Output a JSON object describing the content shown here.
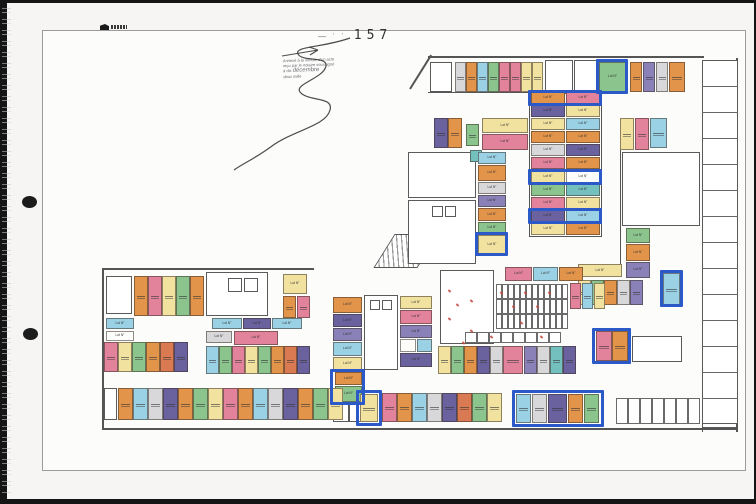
{
  "page": {
    "number": "157",
    "pre_marks": "— ˈ ˈ",
    "stamp_logo": "architect-logo"
  },
  "annotation": {
    "line1": "Annexé à la minute d'un acte",
    "line2": "reçu par le notaire soussigné",
    "line3": "à dix",
    "word_cursive": "décembre",
    "line4": "deux mille"
  },
  "plan": {
    "unit_label": "Lot N°",
    "colors": {
      "o": "#E2944A",
      "r": "#D97A52",
      "p": "#E2839B",
      "y": "#F1E2A0",
      "g": "#8BC48C",
      "pu": "#8A81B8",
      "dpu": "#6A619F",
      "b": "#9AD1E5",
      "t": "#74C0BF",
      "gr": "#D8D8DB",
      "w": "#FDFDFB"
    },
    "highlight_color": "#2B59C8",
    "units": [
      [
        455,
        62,
        11,
        30,
        "gr"
      ],
      [
        466,
        62,
        11,
        30,
        "o"
      ],
      [
        477,
        62,
        11,
        30,
        "b"
      ],
      [
        488,
        62,
        11,
        30,
        "g"
      ],
      [
        499,
        62,
        11,
        30,
        "p"
      ],
      [
        510,
        62,
        11,
        30,
        "p"
      ],
      [
        521,
        62,
        11,
        30,
        "y"
      ],
      [
        532,
        62,
        11,
        30,
        "y"
      ],
      [
        599,
        62,
        27,
        30,
        "g"
      ],
      [
        630,
        62,
        12,
        30,
        "o"
      ],
      [
        643,
        62,
        12,
        30,
        "pu"
      ],
      [
        656,
        62,
        12,
        30,
        "gr"
      ],
      [
        669,
        62,
        16,
        30,
        "o"
      ],
      [
        620,
        118,
        14,
        32,
        "y"
      ],
      [
        635,
        118,
        14,
        32,
        "p"
      ],
      [
        650,
        118,
        17,
        30,
        "b"
      ],
      [
        626,
        228,
        24,
        15,
        "g"
      ],
      [
        626,
        244,
        24,
        17,
        "o"
      ],
      [
        626,
        262,
        24,
        16,
        "pu"
      ],
      [
        578,
        264,
        44,
        13,
        "y"
      ],
      [
        578,
        280,
        13,
        25,
        "y"
      ],
      [
        591,
        280,
        13,
        25,
        "g"
      ],
      [
        604,
        280,
        13,
        25,
        "o"
      ],
      [
        617,
        280,
        13,
        25,
        "gr"
      ],
      [
        630,
        280,
        13,
        25,
        "pu"
      ],
      [
        663,
        273,
        17,
        32,
        "b"
      ],
      [
        596,
        331,
        16,
        30,
        "p"
      ],
      [
        612,
        331,
        16,
        30,
        "o"
      ],
      [
        531,
        92,
        34,
        12,
        "o"
      ],
      [
        566,
        92,
        34,
        12,
        "p"
      ],
      [
        531,
        105,
        34,
        12,
        "dpu"
      ],
      [
        566,
        105,
        34,
        12,
        "y"
      ],
      [
        531,
        118,
        34,
        12,
        "y"
      ],
      [
        566,
        118,
        34,
        12,
        "b"
      ],
      [
        531,
        131,
        34,
        12,
        "o"
      ],
      [
        566,
        131,
        34,
        12,
        "o"
      ],
      [
        531,
        144,
        34,
        12,
        "gr"
      ],
      [
        566,
        144,
        34,
        12,
        "dpu"
      ],
      [
        531,
        157,
        34,
        12,
        "p"
      ],
      [
        566,
        157,
        34,
        12,
        "o"
      ],
      [
        531,
        171,
        34,
        12,
        "y"
      ],
      [
        566,
        171,
        34,
        12,
        "w"
      ],
      [
        531,
        184,
        34,
        12,
        "g"
      ],
      [
        566,
        184,
        34,
        12,
        "t"
      ],
      [
        531,
        197,
        34,
        12,
        "p"
      ],
      [
        566,
        197,
        34,
        12,
        "y"
      ],
      [
        531,
        210,
        34,
        12,
        "dpu"
      ],
      [
        566,
        210,
        34,
        12,
        "b"
      ],
      [
        531,
        223,
        34,
        12,
        "y"
      ],
      [
        566,
        223,
        34,
        12,
        "o"
      ],
      [
        434,
        118,
        14,
        30,
        "dpu"
      ],
      [
        448,
        118,
        14,
        30,
        "o"
      ],
      [
        466,
        124,
        13,
        22,
        "g"
      ],
      [
        482,
        118,
        46,
        15,
        "y"
      ],
      [
        482,
        134,
        46,
        16,
        "p"
      ],
      [
        470,
        150,
        12,
        12,
        "t"
      ],
      [
        478,
        152,
        28,
        12,
        "b"
      ],
      [
        478,
        165,
        28,
        16,
        "o"
      ],
      [
        478,
        182,
        28,
        12,
        "gr"
      ],
      [
        478,
        195,
        28,
        12,
        "pu"
      ],
      [
        478,
        208,
        28,
        13,
        "o"
      ],
      [
        478,
        222,
        28,
        12,
        "g"
      ],
      [
        478,
        235,
        28,
        19,
        "y"
      ],
      [
        134,
        276,
        14,
        40,
        "o"
      ],
      [
        148,
        276,
        14,
        40,
        "p"
      ],
      [
        162,
        276,
        14,
        40,
        "y"
      ],
      [
        176,
        276,
        14,
        40,
        "g"
      ],
      [
        190,
        276,
        14,
        40,
        "o"
      ],
      [
        106,
        318,
        28,
        11,
        "b"
      ],
      [
        106,
        331,
        28,
        10,
        "w"
      ],
      [
        104,
        342,
        14,
        30,
        "p"
      ],
      [
        118,
        342,
        14,
        30,
        "y"
      ],
      [
        132,
        342,
        14,
        30,
        "g"
      ],
      [
        146,
        342,
        14,
        30,
        "o"
      ],
      [
        160,
        342,
        14,
        30,
        "r"
      ],
      [
        174,
        342,
        14,
        30,
        "dpu"
      ],
      [
        283,
        274,
        24,
        20,
        "y"
      ],
      [
        283,
        296,
        13,
        22,
        "o"
      ],
      [
        297,
        296,
        13,
        22,
        "p"
      ],
      [
        212,
        318,
        30,
        11,
        "b"
      ],
      [
        243,
        318,
        28,
        11,
        "dpu"
      ],
      [
        272,
        318,
        30,
        11,
        "b"
      ],
      [
        206,
        331,
        26,
        12,
        "gr"
      ],
      [
        234,
        331,
        44,
        14,
        "p"
      ],
      [
        206,
        346,
        13,
        28,
        "b"
      ],
      [
        219,
        346,
        13,
        28,
        "g"
      ],
      [
        232,
        346,
        13,
        28,
        "p"
      ],
      [
        245,
        346,
        13,
        28,
        "y"
      ],
      [
        258,
        346,
        13,
        28,
        "g"
      ],
      [
        271,
        346,
        13,
        28,
        "o"
      ],
      [
        284,
        346,
        13,
        28,
        "r"
      ],
      [
        297,
        346,
        13,
        28,
        "dpu"
      ],
      [
        333,
        297,
        29,
        16,
        "o"
      ],
      [
        333,
        314,
        29,
        13,
        "dpu"
      ],
      [
        333,
        328,
        29,
        13,
        "pu"
      ],
      [
        333,
        342,
        29,
        14,
        "b"
      ],
      [
        333,
        357,
        29,
        13,
        "y"
      ],
      [
        335,
        372,
        27,
        13,
        "o"
      ],
      [
        335,
        386,
        27,
        16,
        "g"
      ],
      [
        400,
        296,
        32,
        13,
        "y"
      ],
      [
        400,
        310,
        32,
        14,
        "p"
      ],
      [
        400,
        325,
        32,
        13,
        "pu"
      ],
      [
        400,
        339,
        16,
        13,
        "w"
      ],
      [
        417,
        339,
        15,
        13,
        "b"
      ],
      [
        400,
        353,
        32,
        14,
        "dpu"
      ],
      [
        505,
        267,
        27,
        14,
        "p"
      ],
      [
        533,
        267,
        25,
        14,
        "b"
      ],
      [
        559,
        267,
        24,
        14,
        "o"
      ],
      [
        570,
        283,
        11,
        26,
        "p"
      ],
      [
        582,
        283,
        11,
        26,
        "b"
      ],
      [
        594,
        283,
        11,
        26,
        "y"
      ],
      [
        438,
        346,
        13,
        28,
        "y"
      ],
      [
        451,
        346,
        13,
        28,
        "g"
      ],
      [
        464,
        346,
        13,
        28,
        "o"
      ],
      [
        477,
        346,
        13,
        28,
        "dpu"
      ],
      [
        490,
        346,
        13,
        28,
        "gr"
      ],
      [
        503,
        346,
        20,
        28,
        "p"
      ],
      [
        524,
        346,
        13,
        28,
        "pu"
      ],
      [
        537,
        346,
        13,
        28,
        "gr"
      ],
      [
        550,
        346,
        13,
        28,
        "t"
      ],
      [
        563,
        346,
        13,
        28,
        "dpu"
      ],
      [
        118,
        388,
        15,
        32,
        "o"
      ],
      [
        133,
        388,
        15,
        32,
        "b"
      ],
      [
        148,
        388,
        15,
        32,
        "gr"
      ],
      [
        163,
        388,
        15,
        32,
        "dpu"
      ],
      [
        178,
        388,
        15,
        32,
        "o"
      ],
      [
        193,
        388,
        15,
        32,
        "g"
      ],
      [
        208,
        388,
        15,
        32,
        "y"
      ],
      [
        223,
        388,
        15,
        32,
        "p"
      ],
      [
        238,
        388,
        15,
        32,
        "o"
      ],
      [
        253,
        388,
        15,
        32,
        "b"
      ],
      [
        268,
        388,
        15,
        32,
        "gr"
      ],
      [
        283,
        388,
        15,
        32,
        "dpu"
      ],
      [
        298,
        388,
        15,
        32,
        "o"
      ],
      [
        313,
        388,
        15,
        32,
        "g"
      ],
      [
        328,
        388,
        15,
        32,
        "y"
      ],
      [
        360,
        394,
        18,
        28,
        "y"
      ],
      [
        382,
        393,
        15,
        29,
        "p"
      ],
      [
        397,
        393,
        15,
        29,
        "o"
      ],
      [
        412,
        393,
        15,
        29,
        "b"
      ],
      [
        427,
        393,
        15,
        29,
        "gr"
      ],
      [
        442,
        393,
        15,
        29,
        "dpu"
      ],
      [
        457,
        393,
        15,
        29,
        "r"
      ],
      [
        472,
        393,
        15,
        29,
        "g"
      ],
      [
        487,
        393,
        15,
        29,
        "y"
      ],
      [
        516,
        394,
        15,
        29,
        "b"
      ],
      [
        532,
        394,
        15,
        29,
        "gr"
      ],
      [
        548,
        394,
        19,
        29,
        "dpu"
      ],
      [
        568,
        394,
        15,
        29,
        "o"
      ],
      [
        584,
        394,
        15,
        29,
        "g"
      ]
    ],
    "white_rooms": [
      [
        430,
        62,
        22,
        30
      ],
      [
        545,
        60,
        28,
        34
      ],
      [
        574,
        60,
        26,
        34
      ],
      [
        408,
        152,
        68,
        46
      ],
      [
        408,
        200,
        68,
        64
      ],
      [
        622,
        152,
        78,
        74
      ],
      [
        106,
        276,
        26,
        38
      ],
      [
        206,
        272,
        62,
        44
      ],
      [
        364,
        295,
        34,
        75
      ],
      [
        333,
        400,
        16,
        22
      ],
      [
        349,
        400,
        16,
        22
      ],
      [
        440,
        270,
        54,
        74
      ],
      [
        632,
        336,
        50,
        26
      ],
      [
        702,
        392,
        36,
        36
      ],
      [
        104,
        388,
        13,
        32
      ]
    ],
    "small_rooms": [
      [
        432,
        206,
        11,
        11
      ],
      [
        445,
        206,
        11,
        11
      ],
      [
        370,
        300,
        10,
        10
      ],
      [
        382,
        300,
        10,
        10
      ],
      [
        228,
        278,
        14,
        14
      ],
      [
        244,
        278,
        14,
        14
      ]
    ],
    "walls": [
      [
        428,
        56,
        276,
        2
      ],
      [
        736,
        58,
        2,
        374
      ],
      [
        702,
        60,
        1,
        372
      ],
      [
        102,
        428,
        636,
        2
      ],
      [
        102,
        268,
        2,
        162
      ],
      [
        102,
        268,
        212,
        2
      ],
      [
        529,
        90,
        73,
        1
      ],
      [
        529,
        236,
        73,
        1
      ],
      [
        529,
        90,
        1,
        147
      ],
      [
        601,
        90,
        1,
        147
      ],
      [
        428,
        92,
        100,
        1
      ],
      [
        620,
        150,
        1,
        116
      ]
    ],
    "diagonal_wall": {
      "x": 410,
      "y": 88,
      "len": 40,
      "angle": -58
    },
    "highlights": [
      [
        596,
        59,
        32,
        35
      ],
      [
        528,
        90,
        74,
        16
      ],
      [
        528,
        169,
        74,
        16
      ],
      [
        528,
        208,
        74,
        16
      ],
      [
        475,
        232,
        33,
        24
      ],
      [
        660,
        270,
        23,
        37
      ],
      [
        592,
        328,
        39,
        36
      ],
      [
        330,
        369,
        35,
        36
      ],
      [
        356,
        390,
        26,
        36
      ],
      [
        512,
        390,
        92,
        37
      ]
    ],
    "caves_grid": {
      "x": 496,
      "y": 284,
      "rows": 3,
      "cols": 12,
      "cw": 6,
      "ch": 15
    },
    "caves_row": {
      "x": 465,
      "y": 332,
      "rows": 1,
      "cols": 8,
      "cw": 12,
      "ch": 11
    },
    "storage_row": {
      "x": 616,
      "y": 398,
      "rows": 1,
      "cols": 7,
      "cw": 12,
      "ch": 26
    },
    "right_band": {
      "x": 702,
      "y": 60,
      "w": 36,
      "count": 13,
      "step": 26
    },
    "red_marks": [
      [
        448,
        290
      ],
      [
        456,
        304
      ],
      [
        448,
        318
      ],
      [
        470,
        300
      ],
      [
        470,
        330
      ],
      [
        500,
        292
      ],
      [
        512,
        306
      ],
      [
        524,
        292
      ],
      [
        536,
        306
      ],
      [
        548,
        292
      ],
      [
        520,
        322
      ],
      [
        540,
        336
      ],
      [
        490,
        336
      ],
      [
        462,
        342
      ]
    ]
  }
}
